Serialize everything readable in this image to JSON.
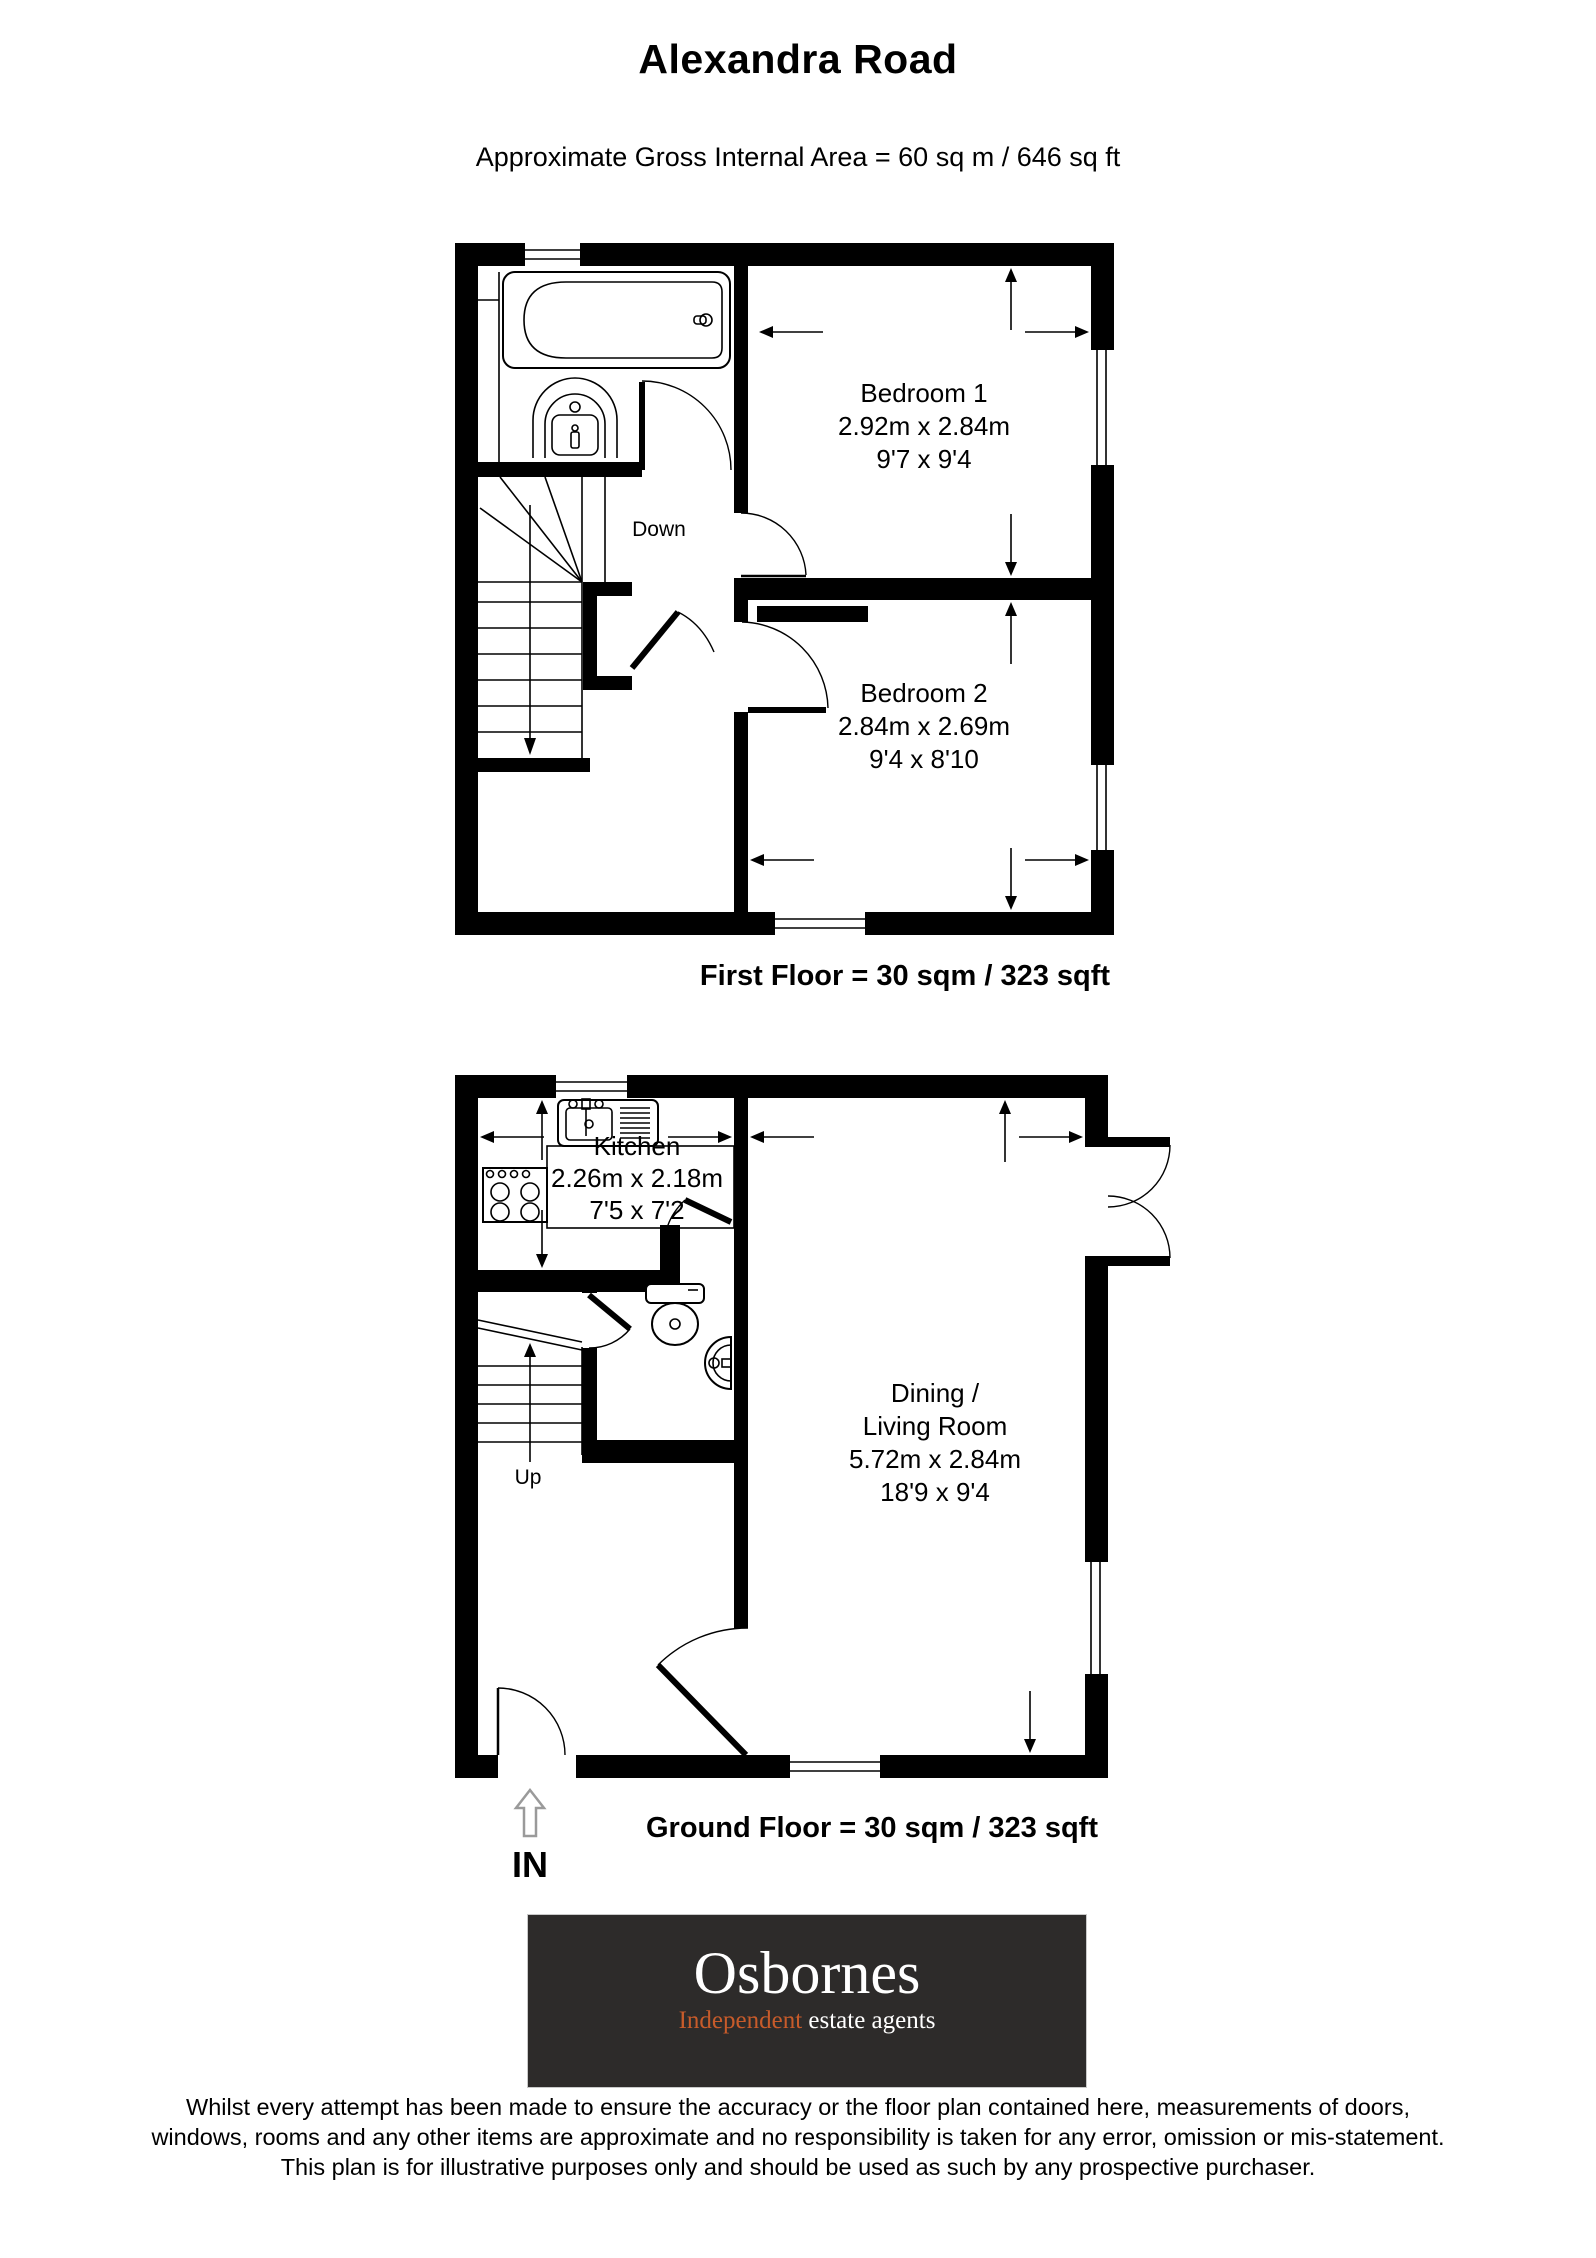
{
  "page": {
    "title": "Alexandra Road",
    "subtitle": "Approximate Gross Internal Area = 60 sq m / 646 sq ft"
  },
  "first_floor": {
    "caption": "First Floor = 30 sqm / 323 sqft",
    "stairs_label": "Down",
    "bedroom1": {
      "name": "Bedroom 1",
      "metric": "2.92m x 2.84m",
      "imperial": "9'7 x 9'4"
    },
    "bedroom2": {
      "name": "Bedroom 2",
      "metric": "2.84m x 2.69m",
      "imperial": "9'4 x 8'10"
    }
  },
  "ground_floor": {
    "caption": "Ground Floor = 30 sqm / 323 sqft",
    "stairs_label": "Up",
    "entrance_label": "IN",
    "kitchen": {
      "name": "Kitchen",
      "metric": "2.26m x 2.18m",
      "imperial": "7'5 x 7'2"
    },
    "living": {
      "name_line1": "Dining /",
      "name_line2": "Living Room",
      "metric": "5.72m x 2.84m",
      "imperial": "18'9 x 9'4"
    }
  },
  "logo": {
    "brand": "Osbornes",
    "tagline_highlight": "Independent",
    "tagline_rest": " estate agents",
    "background": "#2d2b2a",
    "accent": "#c75b2a"
  },
  "disclaimer": {
    "line1": "Whilst every attempt has been made to ensure the accuracy or the floor plan contained here, measurements of doors,",
    "line2": "windows, rooms and any other items are approximate and no responsibility is taken for any error, omission or mis-statement.",
    "line3": "This plan is for illustrative purposes only and should be used as such by any prospective purchaser."
  }
}
